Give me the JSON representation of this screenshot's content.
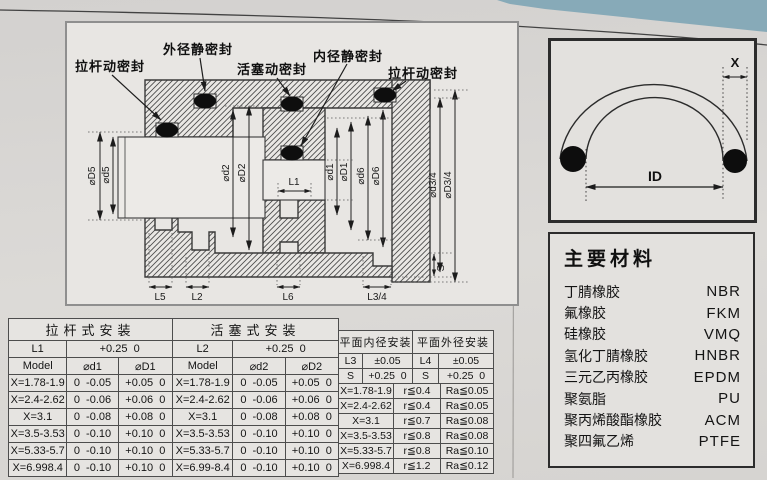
{
  "page": {
    "paper_color": "#dcdad7",
    "ink_color": "#1a1a1a",
    "corner_accent": "#87aab8"
  },
  "diagram": {
    "callouts": [
      "拉杆动密封",
      "外径静密封",
      "活塞动密封",
      "内径静密封",
      "拉杆动密封"
    ],
    "dims": {
      "D5": "⌀D5",
      "d5": "⌀d5",
      "d2": "⌀d2",
      "D2": "⌀D2",
      "d1": "⌀d1",
      "D1": "⌀D1",
      "d6": "⌀d6",
      "D6": "⌀D6",
      "d34": "⌀d3/4",
      "D34": "⌀D3/4",
      "L1": "L1",
      "L5": "L5",
      "L2": "L2",
      "L6": "L6",
      "L34": "L3/4",
      "S": "S"
    }
  },
  "oring": {
    "x_label": "X",
    "id_label": "ID"
  },
  "materials": {
    "title": "主要材料",
    "items": [
      {
        "name": "丁腈橡胶",
        "code": "NBR"
      },
      {
        "name": "氟橡胶",
        "code": "FKM"
      },
      {
        "name": "硅橡胶",
        "code": "VMQ"
      },
      {
        "name": "氢化丁腈橡胶",
        "code": "HNBR"
      },
      {
        "name": "三元乙丙橡胶",
        "code": "EPDM"
      },
      {
        "name": "聚氨脂",
        "code": "PU"
      },
      {
        "name": "聚丙烯酸酯橡胶",
        "code": "ACM"
      },
      {
        "name": "聚四氟乙烯",
        "code": "PTFE"
      }
    ]
  },
  "tables": {
    "rod": {
      "title": "拉杆式安装",
      "dim": "L1",
      "dim_tol": "+0.25  0",
      "headers": [
        "Model",
        "⌀d1",
        "⌀D1"
      ],
      "rows": [
        [
          "X=1.78-1.9",
          "0  -0.05",
          "+0.05  0"
        ],
        [
          "X=2.4-2.62",
          "0  -0.06",
          "+0.06  0"
        ],
        [
          "X=3.1",
          "0  -0.08",
          "+0.08  0"
        ],
        [
          "X=3.5-3.53",
          "0  -0.10",
          "+0.10  0"
        ],
        [
          "X=5.33-5.7",
          "0  -0.10",
          "+0.10  0"
        ],
        [
          "X=6.998.4",
          "0  -0.10",
          "+0.10  0"
        ]
      ]
    },
    "piston": {
      "title": "活塞式安装",
      "dim": "L2",
      "dim_tol": "+0.25  0",
      "headers": [
        "Model",
        "⌀d2",
        "⌀D2"
      ],
      "rows": [
        [
          "X=1.78-1.9",
          "0  -0.05",
          "+0.05  0"
        ],
        [
          "X=2.4-2.62",
          "0  -0.06",
          "+0.06  0"
        ],
        [
          "X=3.1",
          "0  -0.08",
          "+0.08  0"
        ],
        [
          "X=3.5-3.53",
          "0  -0.10",
          "+0.10  0"
        ],
        [
          "X=5.33-5.7",
          "0  -0.10",
          "+0.10  0"
        ],
        [
          "X=6.99-8.4",
          "0  -0.10",
          "+0.10  0"
        ]
      ]
    },
    "face": {
      "inner_title": "平面内径安装",
      "outer_title": "平面外径安装",
      "inner_dim": "L3",
      "inner_dim_tol": "±0.05",
      "inner_s": "S",
      "inner_s_tol": "+0.25  0",
      "outer_dim": "L4",
      "outer_dim_tol": "±0.05",
      "outer_s": "S",
      "outer_s_tol": "+0.25  0",
      "rows": [
        [
          "X=1.78-1.9",
          "r≦0.4",
          "Ra≦0.05"
        ],
        [
          "X=2.4-2.62",
          "r≦0.4",
          "Ra≦0.05"
        ],
        [
          "X=3.1",
          "r≦0.7",
          "Ra≦0.08"
        ],
        [
          "X=3.5-3.53",
          "r≦0.8",
          "Ra≦0.08"
        ],
        [
          "X=5.33-5.7",
          "r≦0.8",
          "Ra≦0.10"
        ],
        [
          "X=6.998.4",
          "r≦1.2",
          "Ra≦0.12"
        ]
      ]
    }
  }
}
